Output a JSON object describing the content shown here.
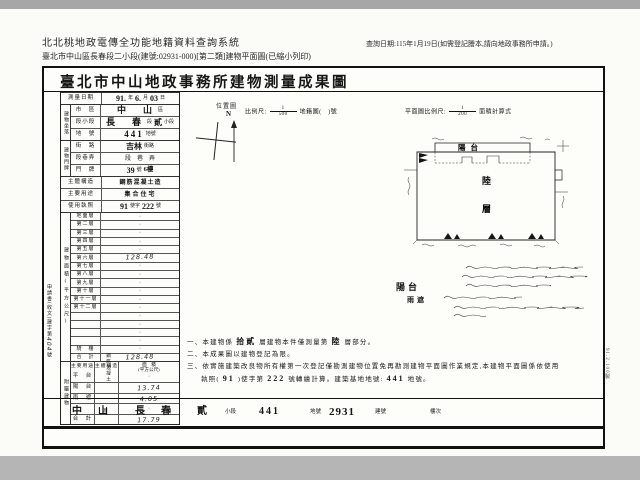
{
  "header": {
    "system_title": "北北桃地政電傳全功能地籍資料查詢系統",
    "query_date": "查詢日期:115年1月19日(如需登記謄本,請向地政事務所申請。)",
    "subtitle": "臺北市中山區長春段二小段(建號:02931-000)[第二類]建物平面圖(已縮小列印)"
  },
  "doc": {
    "title": "臺北市中山地政事務所建物測量成果圖"
  },
  "scales": {
    "location_label": "位置圖",
    "north": "N",
    "map_prefix": "比例尺:",
    "map_num": "1",
    "map_den": "500",
    "map_suffix": "地籍圖(　)號",
    "plan_prefix": "平面圖比例尺:",
    "plan_num": "1",
    "plan_den": "200",
    "plan_suffix": "面積計算式"
  },
  "survey": {
    "label": "測量日期",
    "v1": "91.",
    "u1": "年",
    "v2": "6.",
    "u2": "月",
    "v3": "03",
    "u3": "日"
  },
  "site": {
    "group": "建物坐落",
    "district_label": "市　區",
    "district": "中　山",
    "district_u": "區",
    "section_label": "段小段",
    "section": "長　春",
    "section_mid": "段",
    "subsection": "貳",
    "subsection_u": "小段",
    "lot_label": "地　號",
    "lot": "441",
    "lot_u": "地號"
  },
  "addr": {
    "group": "建物門牌",
    "street_label": "街　路",
    "street": "吉林",
    "street_u": "街路",
    "lane_label": "段巷弄",
    "lane_value": "段　巷　弄",
    "door_label": "門　牌",
    "door": "39",
    "door_mid": "號",
    "door_floor": "6樓"
  },
  "structure": {
    "label": "主體構造",
    "value": "鋼筋混凝土造"
  },
  "usage": {
    "label": "主要用途",
    "value": "集合住宅"
  },
  "license": {
    "label": "使用執照",
    "v1": "91",
    "mid": "使字",
    "v2": "222",
    "suffix": "號"
  },
  "floor_area": {
    "group": "建物面積(平方公尺)",
    "rows": [
      {
        "label": "地面層",
        "value": "·"
      },
      {
        "label": "第二層",
        "value": "·"
      },
      {
        "label": "第三層",
        "value": "·"
      },
      {
        "label": "第四層",
        "value": "·"
      },
      {
        "label": "第五層",
        "value": "·"
      },
      {
        "label": "第六層",
        "value": "128.48",
        "hw": true
      },
      {
        "label": "第七層",
        "value": "·"
      },
      {
        "label": "第八層",
        "value": "·"
      },
      {
        "label": "第九層",
        "value": "·"
      },
      {
        "label": "第十層",
        "value": "·"
      },
      {
        "label": "第十一層",
        "value": "·"
      },
      {
        "label": "第十二層",
        "value": "·"
      },
      {
        "label": "",
        "value": "·"
      },
      {
        "label": "",
        "value": "·"
      },
      {
        "label": "",
        "value": "·"
      },
      {
        "label": "",
        "value": "·"
      },
      {
        "label": "騎　樓",
        "value": "·"
      },
      {
        "label": "合　計",
        "value": "128.48",
        "hw": true
      }
    ]
  },
  "attached": {
    "group": "附屬建物",
    "headers": {
      "use": "主要用途",
      "structure": "主體構造",
      "area": "面　積",
      "area_sub": "(平方公尺)"
    },
    "structure_text": "鋼筋混凝土",
    "rows": [
      {
        "use": "平　台",
        "area": "·"
      },
      {
        "use": "陽　台",
        "area": "13.74",
        "hw": true
      },
      {
        "use": "雨　遮",
        "area": "4.05",
        "hw": true
      },
      {
        "use": "",
        "area": "·"
      },
      {
        "use": "合　計",
        "area": "17.79",
        "hw": true
      }
    ]
  },
  "plan": {
    "balcony": "陽台",
    "floor1": "陸",
    "floor2": "層",
    "calc_balcony": "陽台",
    "calc_canopy": "雨遮"
  },
  "notes": {
    "l1a": "一、本建物係",
    "l1b": "拾貳",
    "l1c": "層建物本件僅測量第",
    "l1d": "陸",
    "l1e": "層部分。",
    "l2": "二、本成果圖以建物登記為限。",
    "l3": "三、依實施建築改良物所有權第一次登記僅勘測建物位置免再勘測建物平面圖作業規定,本建物平面圖係依使用",
    "l4a": "執照(",
    "l4b": "91",
    "l4c": ")使字第",
    "l4d": "222",
    "l4e": "號轉繪計算。建築基地地號:",
    "l4f": "441",
    "l4g": "地號。"
  },
  "strip": {
    "district": "中　山",
    "district_u": "區",
    "section": "長　春",
    "section_u": "段",
    "subsection": "貳",
    "subsection_u": "小段",
    "lot": "441",
    "lot_u": "地號",
    "bno": "2931",
    "bno_u": "建號",
    "floor_u": "樓次"
  },
  "misc": {
    "margin_note": "申請書(收文)建字第",
    "margin_hw": "404",
    "margin_suffix": "號",
    "print_code": "91.2.100製"
  }
}
